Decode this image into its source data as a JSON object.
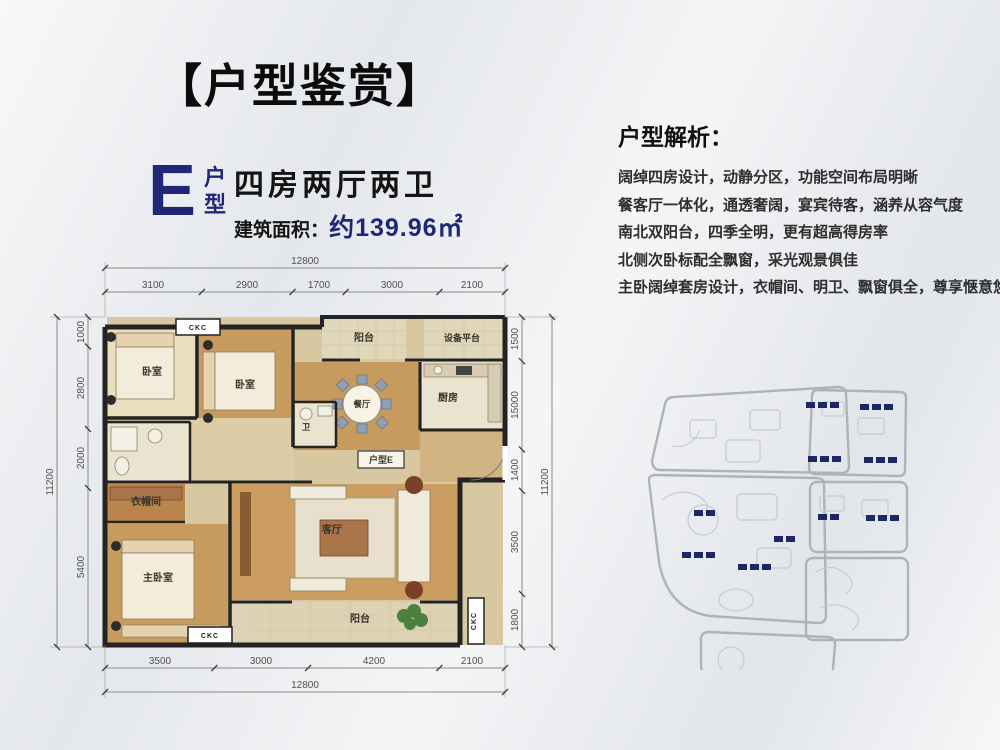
{
  "page": {
    "title": "【户型鉴赏】"
  },
  "unit": {
    "letter": "E",
    "hu": "户",
    "xing": "型",
    "layout": "四房两厅两卫",
    "area_label": "建筑面积：",
    "area_value": "约139.96㎡"
  },
  "analysis": {
    "heading": "户型解析：",
    "lines": [
      "阔绰四房设计，动静分区，功能空间布局明晰",
      "餐客厅一体化，通透奢阔，宴宾待客，涵养从容气度",
      "南北双阳台，四季全明，更有超高得房率",
      "北侧次卧标配全飘窗，采光观景俱佳",
      "主卧阔绰套房设计，衣帽间、明卫、飘窗俱全，尊享惬意悠然"
    ]
  },
  "plan": {
    "rooms": {
      "bedroom1": "卧室",
      "bedroom2": "卧室",
      "balcony_top": "阳台",
      "equipment": "设备平台",
      "dining": "餐厅",
      "kitchen": "厨房",
      "bath": "卫",
      "unit_tag": "户型E",
      "cloak": "衣帽间",
      "living": "客厅",
      "master": "主卧室",
      "balcony_bottom": "阳台"
    },
    "window_code": "CKC",
    "dims": {
      "top_total": "12800",
      "top": [
        "3100",
        "2900",
        "1700",
        "3000",
        "2100"
      ],
      "left_total": "11200",
      "left": [
        "1000",
        "2800",
        "2000",
        "5400"
      ],
      "right": [
        "1500",
        "15000",
        "1400",
        "3500",
        "1800"
      ],
      "right_total": "11200",
      "bottom": [
        "3500",
        "3000",
        "4200",
        "2100"
      ],
      "bottom_total": "12800"
    }
  },
  "colors": {
    "navy": "#1f2776",
    "black": "#111111",
    "wall": "#222222",
    "wood": "#c9995f",
    "dim_line": "#8a8a86",
    "site_outline": "#aeb3bb",
    "site_building": "#1d2766"
  }
}
